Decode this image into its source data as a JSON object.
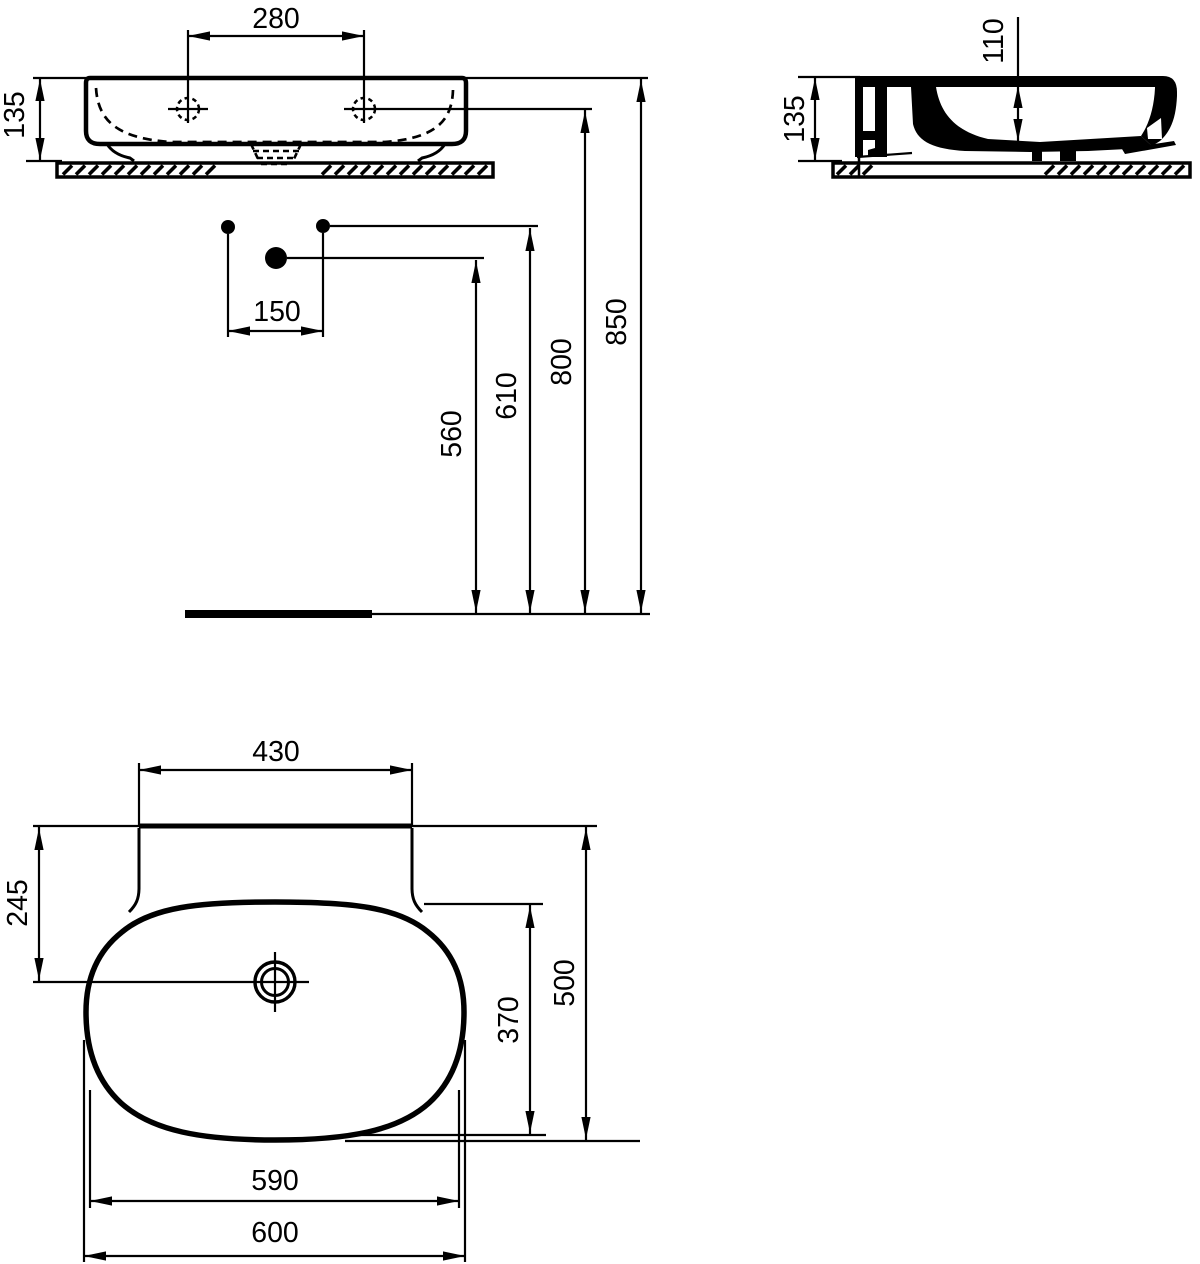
{
  "drawing": {
    "type": "technical-dimension-drawing",
    "subject": "countertop washbasin with three orthographic views",
    "ink_color": "#000000",
    "background_color": "#ffffff",
    "views": {
      "front": {
        "label": "front-elevation",
        "dims": {
          "tap_hole_spacing": "280",
          "basin_height": "135",
          "connection_offset": "150",
          "drain_connection_height": "560",
          "supply_connection_height": "610",
          "tap_hole_height": "800",
          "rim_height": "850"
        }
      },
      "side": {
        "label": "side-section",
        "dims": {
          "basin_height": "135",
          "bowl_depth": "110"
        }
      },
      "plan": {
        "label": "plan-view",
        "dims": {
          "back_ledge_width": "430",
          "back_to_drain": "245",
          "bowl_front_to_back": "370",
          "overall_depth": "500",
          "bowl_width": "590",
          "overall_width": "600"
        }
      }
    }
  }
}
